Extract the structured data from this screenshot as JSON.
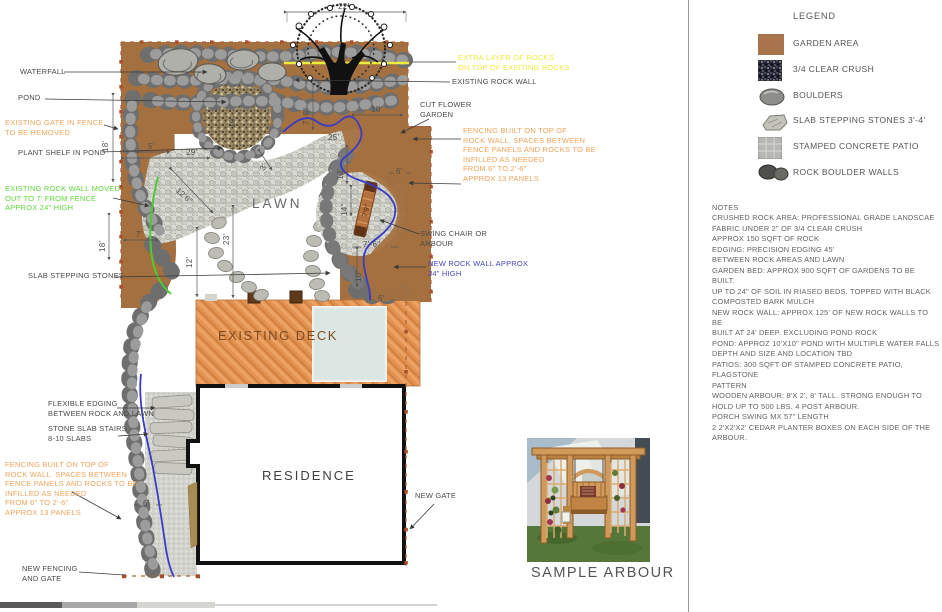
{
  "legend": {
    "title": "LEGEND",
    "items": [
      {
        "icon": "garden-area-swatch",
        "label": "GARDEN AREA"
      },
      {
        "icon": "clear-crush-swatch",
        "label": "3/4 CLEAR CRUSH"
      },
      {
        "icon": "boulder-icon",
        "label": "BOULDERS"
      },
      {
        "icon": "slab-stone-icon",
        "label": "SLAB STEPPING STONES 3'-4'"
      },
      {
        "icon": "stamped-concrete-swatch",
        "label": "STAMPED CONCRETE PATIO"
      },
      {
        "icon": "rock-wall-icon",
        "label": "ROCK BOULDER WALLS"
      }
    ]
  },
  "notes": {
    "lines": [
      "NOTES",
      "CRUSHED ROCK AREA: PROFESSIONAL GRADE LANDSCAE",
      "FABRIC UNDER 2\" OF 3/4 CLEAR CRUSH",
      "APPROX 150 SQFT OF ROCK",
      "EDGING: PRECISION EDGING 45'",
      "BETWEEN ROCK AREAS AND LAWN",
      "GARDEN BED: APPROX 900 SQFT OF GARDENS TO BE BUILT.",
      "UP TO 24\" OF SOIL IN RIASED BEDS. TOPPED WITH BLACK",
      "COMPOSTED BARK MULCH",
      "NEW ROCK WALL: APPROX 125' OF NEW ROCK WALLS TO BE",
      "BUILT AT 24' DEEP. EXCLUDING POND ROCK",
      "POND: APPROZ 10'X10\" POND WITH MULTIPLE WATER FALLS",
      "DEPTH AND SIZE AND LOCATION TBD",
      "PATIOS: 300 SQFT OF STAMPED CONCRETE PATIO, FLAGSTONE",
      "PATTERN",
      "WOODEN ARBOUR: 8'X 2', 8' TALL. STRONG ENOUGH TO",
      "HOLD UP TO 500 LBS. 4 POST ARBOUR.",
      "PORCH SWING MX 57\" LENGTH",
      "2 2'X2'X2' CEDAR PLANTER BOXES ON EACH SIDE OF THE",
      "ARBOUR."
    ]
  },
  "plan": {
    "areas": {
      "lawn": "LAWN",
      "deck": "EXISTING DECK",
      "residence": "RESIDENCE"
    },
    "callouts": {
      "waterfall": {
        "lines": [
          "WATERFALL"
        ]
      },
      "pond": {
        "lines": [
          "POND"
        ]
      },
      "existing_gate": {
        "lines": [
          "EXISTING GATE IN FENCE",
          "TO BE REMOVED"
        ]
      },
      "plant_shelf": {
        "lines": [
          "PLANT SHELF IN POND"
        ]
      },
      "rock_wall_moved": {
        "lines": [
          "EXISTING ROCK WALL MOVED",
          "OUT TO 7' FROM FENCE",
          "APPROX 24\" HIGH"
        ]
      },
      "slab_stepping_stones": {
        "lines": [
          "SLAB STEPPING STONES"
        ]
      },
      "flexible_edging": {
        "lines": [
          "FLEXIBLE EDGING",
          "BETWEEN ROCK AND LAWN"
        ]
      },
      "stone_slab_stairs": {
        "lines": [
          "STONE SLAB STAIRS",
          "8-10 SLABS"
        ]
      },
      "fencing_left": {
        "lines": [
          "FENCING BUILT ON TOP OF",
          "ROCK WALL. SPACES BETWEEN",
          "FENCE PANELS AND ROCKS TO BE",
          "INFILLED AS NEEDED",
          "FROM 6\" TO 2'-6\"",
          "APPROX 13 PANELS"
        ]
      },
      "new_fencing": {
        "lines": [
          "NEW FENCING",
          "AND GATE"
        ]
      },
      "extra_layer": {
        "lines": [
          "EXTRA LAYER OF ROCKS",
          "ON TOP OF EXISTING ROCKS"
        ]
      },
      "existing_rock_wall": {
        "lines": [
          "EXISTING ROCK WALL"
        ]
      },
      "cut_flower_garden": {
        "lines": [
          "CUT FLOWER",
          "GARDEN"
        ]
      },
      "fencing_right": {
        "lines": [
          "FENCING BUILT ON TOP OF",
          "ROCK WALL. SPACES BETWEEN",
          "FENCE PANELS AND ROCKS TO BE",
          "INFILLED AS NEEDED",
          "FROM 6\" TO 2'-6\"",
          "APPROX 13 PANELS"
        ]
      },
      "swing_chair": {
        "lines": [
          "SWING CHAIR OR",
          "ARBOUR"
        ]
      },
      "new_rock_wall": {
        "lines": [
          "NEW ROCK WALL APPROX",
          "24\" HIGH"
        ]
      },
      "new_gate": {
        "lines": [
          "NEW GATE"
        ]
      }
    },
    "dims": {
      "d22": "22'",
      "d29": "29'",
      "d5": "5'",
      "d18a": "18'",
      "d18b": "18'",
      "d7": "7'",
      "d10_pond": "10'",
      "d3": "3'",
      "d12_6": "12'6\"",
      "d23": "23'",
      "d12": "12'",
      "d7_6a": "7'-6\"",
      "d10_cf": "10'",
      "d25": "25'",
      "d13": "13'",
      "d6a": "6'",
      "d14": "14\"",
      "d7_9": "7'9\"",
      "d7_6b": "7'-6\"",
      "d10b": "10'",
      "d6b": "6'",
      "d6c": "6'"
    },
    "colors": {
      "garden_brown": "#a4703f",
      "new_rock_wall_blue": "#3a3ac8",
      "moved_wall_green": "#4ecb35",
      "extra_rocks_yellow": "#e8e63c",
      "deck_orange": "#e2914f"
    }
  },
  "sample_arbour": {
    "caption": "SAMPLE ARBOUR"
  }
}
